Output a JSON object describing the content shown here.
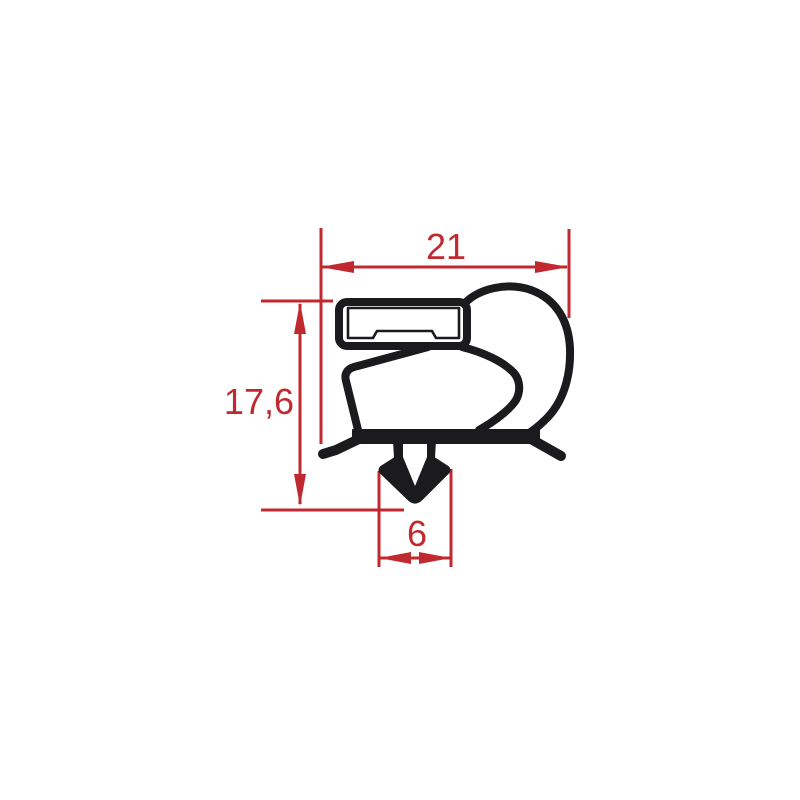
{
  "diagram": {
    "kind": "gasket-profile-dimensioned-drawing",
    "dimensions": [
      {
        "id": "overall-width",
        "label": "21",
        "orientation": "horizontal"
      },
      {
        "id": "overall-height",
        "label": "17,6",
        "orientation": "vertical"
      },
      {
        "id": "dart-width",
        "label": "6",
        "orientation": "horizontal"
      }
    ],
    "colors": {
      "profile_black": "#1b1b1d",
      "dimension_red": "#c0292f",
      "background": "#ffffff"
    }
  }
}
